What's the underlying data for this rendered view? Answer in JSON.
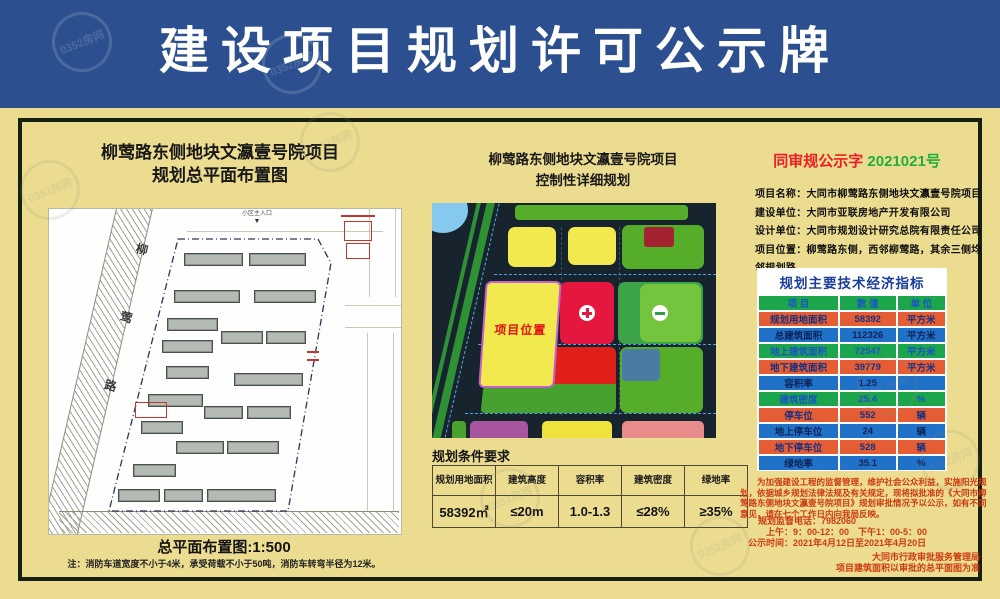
{
  "banner": {
    "title": "建设项目规划许可公示牌"
  },
  "left": {
    "title_line1": "柳莺路东侧地块文瀛壹号院项目",
    "title_line2": "规划总平面布置图",
    "road_label": "柳莺路",
    "entrance_label": "小区主入口",
    "caption": "总平面布置图:1:500",
    "note": "注：消防车道宽度不小于4米，承受荷载不小于50吨，消防车转弯半径为12米。"
  },
  "middle": {
    "title_line1": "柳莺路东侧地块文瀛壹号院项目",
    "title_line2": "控制性详细规划",
    "map_label": "项目位置",
    "conditions": {
      "title": "规划条件要求",
      "headers": [
        "规划用地面积",
        "建筑高度",
        "容积率",
        "建筑密度",
        "绿地率"
      ],
      "values": [
        "58392㎡",
        "≤20m",
        "1.0-1.3",
        "≤28%",
        "≥35%"
      ]
    }
  },
  "right": {
    "notice_no_prefix": "同审规公示字",
    "notice_no_number": "2021021号",
    "info": [
      {
        "label": "项目名称：",
        "value": "大同市柳莺路东侧地块文瀛壹号院项目"
      },
      {
        "label": "建设单位：",
        "value": "大同市亚联房地产开发有限公司"
      },
      {
        "label": "设计单位：",
        "value": "大同市规划设计研究总院有限责任公司"
      },
      {
        "label": "项目位置：",
        "value": "柳莺路东侧，西邻柳莺路，其余三侧均邻规划路"
      }
    ],
    "indicators": {
      "title": "规划主要技术经济指标",
      "headers": [
        "项  目",
        "数  值",
        "单  位"
      ],
      "rows": [
        [
          "规划用地面积",
          "58392",
          "平方米"
        ],
        [
          "总建筑面积",
          "112326",
          "平方米"
        ],
        [
          "地上建筑面积",
          "72547",
          "平方米"
        ],
        [
          "地下建筑面积",
          "39779",
          "平方米"
        ],
        [
          "容积率",
          "1.25",
          ""
        ],
        [
          "建筑密度",
          "25.4",
          "%"
        ],
        [
          "停车位",
          "552",
          "辆"
        ],
        [
          "地上停车位",
          "24",
          "辆"
        ],
        [
          "地下停车位",
          "528",
          "辆"
        ],
        [
          "绿地率",
          "35.1",
          "%"
        ]
      ]
    },
    "notice_text": "为加强建设工程的监督管理，维护社会公众利益，实施阳光规划，依据城乡规划法律法规及有关规定，现将拟批准的《大同市柳莺路东侧地块文瀛壹号院项目》规划审批情况予以公示，如有不同意见，请在七个工作日内向我局反映。",
    "phone_line": "规划监督电话：7982060",
    "hours_line": "上午：9：00-12：00　下午1：00-5：00",
    "period_line": "公示时间：2021年4月12日至2021年4月20日",
    "agency_line1": "大同市行政审批服务管理局",
    "agency_line2": "项目建筑面积以审批的总平面图为准"
  },
  "watermark": {
    "text": "0352房网"
  }
}
